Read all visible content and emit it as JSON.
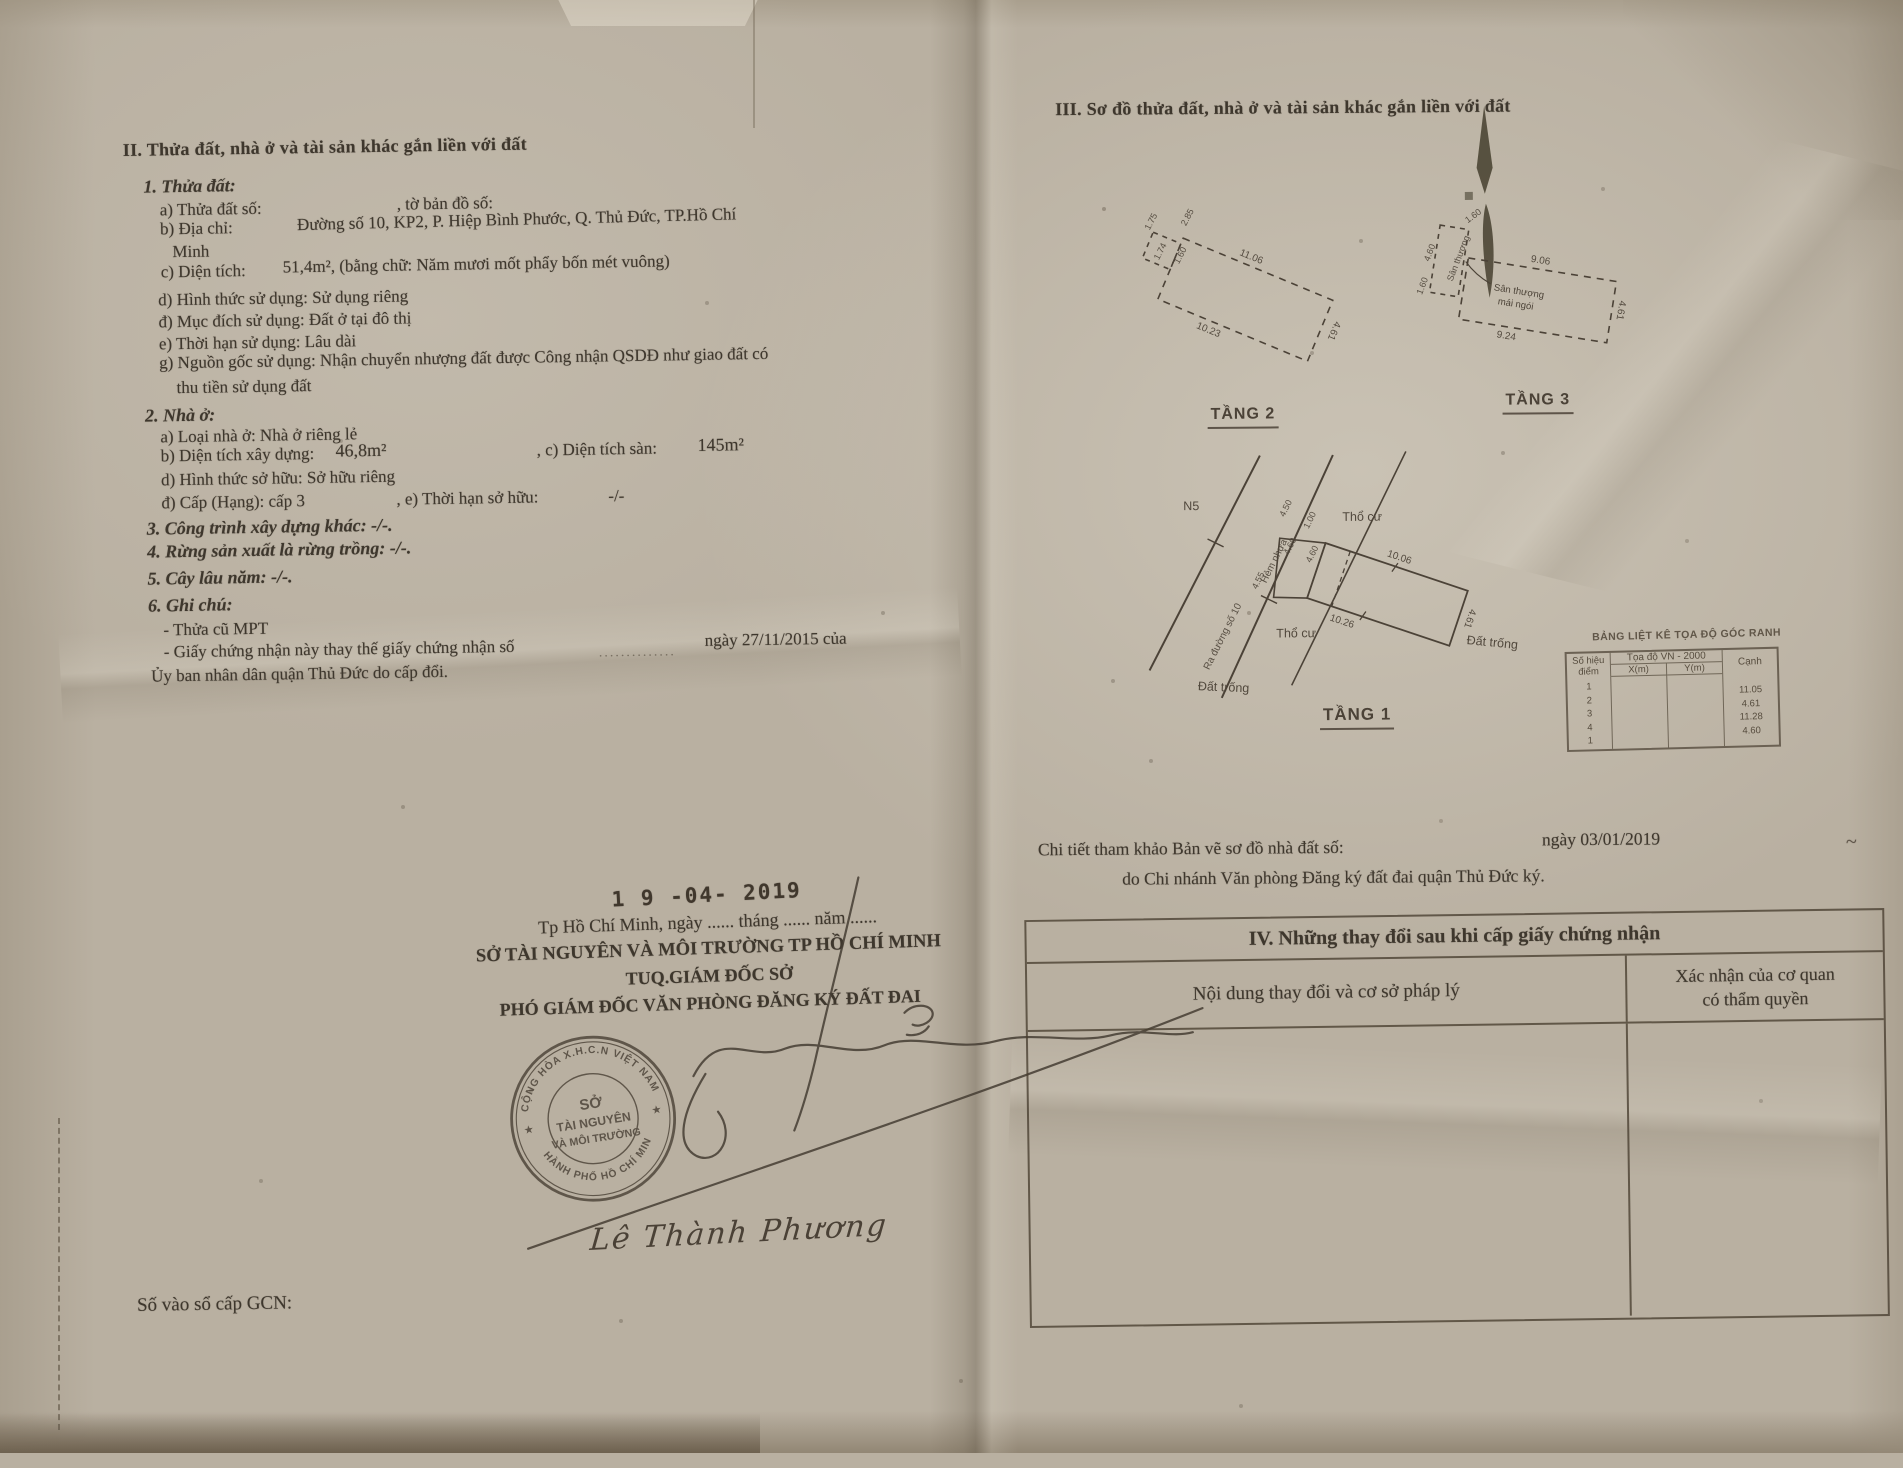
{
  "colors": {
    "paper": "#bcb3a4",
    "ink": "#3e372d",
    "stamp_ink": "#4c4337",
    "diagram_ink": "#4b4237"
  },
  "left": {
    "sec2_heading": "II. Thửa đất, nhà ở và tài sản khác gắn liền với đất",
    "p1_title": "1. Thửa đất:",
    "p1a_label": "a) Thửa đất số:",
    "p1a_mid": ", tờ bản đồ số:",
    "p1b_label": "b) Địa chỉ:",
    "p1b_value": "Đường số 10, KP2, P. Hiệp Bình Phước, Q. Thủ Đức, TP.Hồ Chí",
    "p1b_value2": "Minh",
    "p1c_label": "c) Diện tích:",
    "p1c_value": "51,4m², (bằng chữ: Năm mươi mốt phẩy bốn mét vuông)",
    "p1d": "d) Hình thức sử dụng:  Sử dụng riêng",
    "p1dd": "đ) Mục đích sử dụng:  Đất ở tại đô thị",
    "p1e": "e) Thời hạn sử dụng:  Lâu dài",
    "p1g": "g) Nguồn gốc sử dụng: Nhận chuyển nhượng đất được Công nhận QSDĐ như giao đất có",
    "p1g2": "thu tiền sử dụng đất",
    "p2_title": "2. Nhà ở:",
    "p2a": "a) Loại nhà ở:      Nhà ở riêng lẻ",
    "p2b_label": "b) Diện tích xây dựng:",
    "p2b_value": "46,8m²",
    "p2c_label": ", c) Diện tích sàn:",
    "p2c_value": "145m²",
    "p2d": "d) Hình thức sở hữu:      Sở hữu riêng",
    "p2dd": "đ) Cấp (Hạng):  cấp 3",
    "p2e_label": ", e) Thời hạn sở hữu:",
    "p2e_value": "-/-",
    "p3": "3. Công trình xây dựng khác: -/-.",
    "p4": "4. Rừng sản xuất là rừng trồng: -/-.",
    "p5": "5. Cây lâu năm: -/-.",
    "p6": "6. Ghi chú:",
    "note1": "- Thửa cũ MPT",
    "note2a": "- Giấy chứng nhận này thay thế giấy chứng nhận số",
    "note2_dots": "..............",
    "note2b": "ngày 27/11/2015 của",
    "note3": "Ủy ban nhân dân quận Thủ Đức do cấp đổi.",
    "date_stamp": "1 9 -04- 2019",
    "sign_place": "Tp Hồ Chí Minh, ngày ...... tháng ...... năm ......",
    "sign_org": "SỞ TÀI NGUYÊN VÀ MÔI TRƯỜNG TP HỒ CHÍ MINH",
    "sign_tuq": "TUQ.GIÁM ĐỐC SỞ",
    "sign_role": "PHÓ GIÁM ĐỐC VĂN PHÒNG ĐĂNG KÝ ĐẤT ĐAI",
    "stamp": {
      "ring_top": "CỘNG HÒA X.H.C.N VIỆT NAM",
      "ring_bottom": "THÀNH PHỐ HỒ CHÍ MINH",
      "line1": "SỞ",
      "line2": "TÀI NGUYÊN",
      "line3": "VÀ MÔI TRƯỜNG",
      "star": "★"
    },
    "signer_name": "Lê Thành Phương",
    "gcn_label": "Số vào sổ cấp GCN:"
  },
  "right": {
    "sec3_heading": "III. Sơ đồ thửa đất, nhà ở và tài sản khác gắn liền với đất",
    "f2": {
      "name": "TẦNG 2",
      "d_top": "11.06",
      "d_bottom": "10.23",
      "d_right": "4.61",
      "e1": "2.85",
      "e2": "1.75",
      "e3": "1.74",
      "e4": "1.60"
    },
    "f3": {
      "name": "TẦNG 3",
      "d_top": "9.06",
      "d_bottom": "9.24",
      "d_right": "4.61",
      "strip_label": "Sân thượng",
      "strip_w": "4.60",
      "t1": "1.60",
      "t2": "1.60",
      "ann1": "Sân thượng",
      "ann2": "mái ngói"
    },
    "f1": {
      "name": "TẦNG 1",
      "n5": "N5",
      "road_label": "Ra đường số 10",
      "alley_label": "Hẻm nhựa",
      "d1": "4.50",
      "d2": "4.60",
      "d3": "4.60",
      "d4": "1.00",
      "d5": "4.55",
      "d_top": "10.06",
      "d_bottom": "10.26",
      "d_right": "4.61",
      "zone1": "Thổ cư",
      "zone2": "Thổ cư",
      "zone3": "Đất trống",
      "zone4": "Đất trống"
    },
    "coord_table": {
      "title": "BẢNG LIỆT KÊ TỌA ĐỘ GÓC RANH",
      "h_point1": "Số hiệu",
      "h_point2": "điểm",
      "h_sys": "Tọa độ VN - 2000",
      "h_x": "X(m)",
      "h_y": "Y(m)",
      "h_edge": "Cạnh",
      "points": [
        "1",
        "2",
        "3",
        "4",
        "1"
      ],
      "edges": [
        "11.05",
        "4.61",
        "11.28",
        "4.60"
      ]
    },
    "ref1a": "Chi tiết tham khảo Bản vẽ sơ đồ nhà đất số:",
    "ref1b": "ngày 03/01/2019",
    "ref2": "do Chi nhánh Văn phòng Đăng ký đất đai quận Thủ Đức ký.",
    "tick": "~",
    "sec4": {
      "title": "IV. Những thay đổi sau khi cấp giấy chứng nhận",
      "col1": "Nội dung thay đổi và cơ sở pháp lý",
      "col2a": "Xác nhận của cơ quan",
      "col2b": "có thẩm quyền"
    }
  }
}
